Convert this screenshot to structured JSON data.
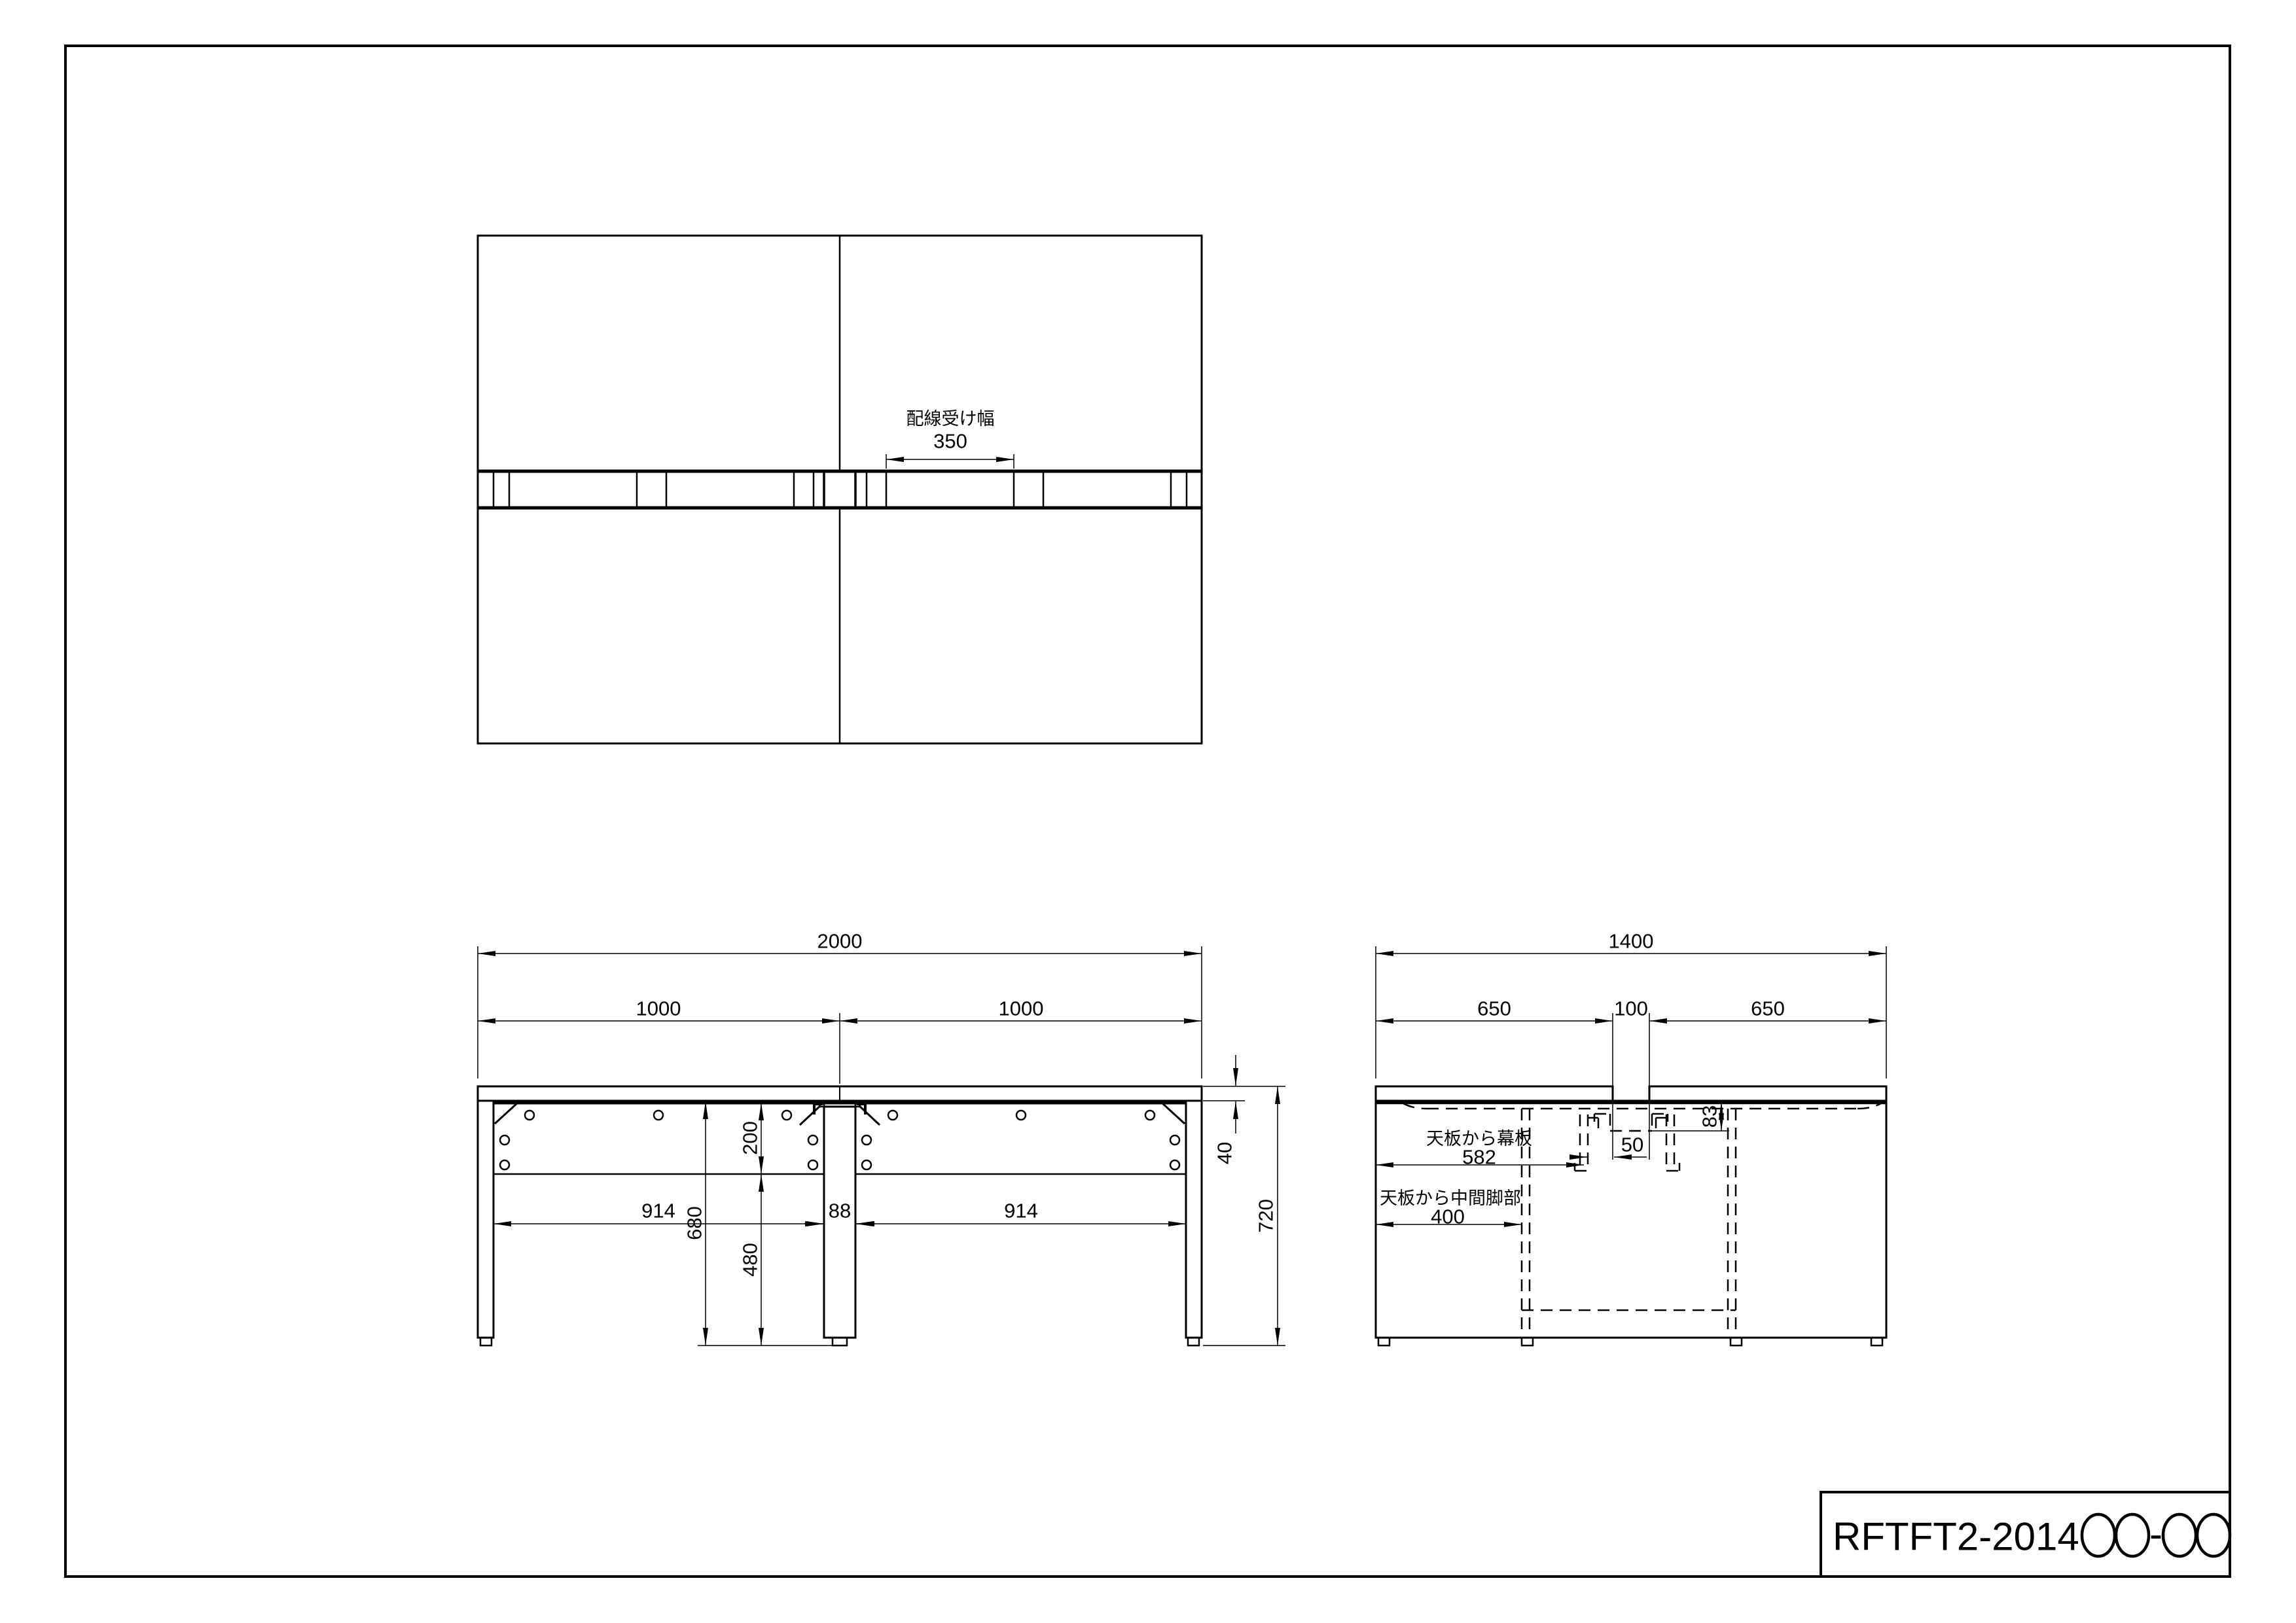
{
  "colors": {
    "ink": "#000000",
    "paper": "#ffffff"
  },
  "title_block": {
    "code_prefix": "RFTFT2-2014",
    "code_separator": "-"
  },
  "top_view": {
    "cable_width_label": "配線受け幅",
    "cable_width_value": "350"
  },
  "front_view": {
    "overall_width": "2000",
    "left_half_width": "1000",
    "right_half_width": "1000",
    "left_leg_span": "914",
    "center_leg_width": "88",
    "right_leg_span": "914",
    "panel_height": "200",
    "panel_bottom_to_floor": "480",
    "under_top_to_floor": "680",
    "top_thickness": "40",
    "total_height": "720"
  },
  "side_view": {
    "overall_depth": "1400",
    "left_top_depth": "650",
    "center_gap": "100",
    "right_top_depth": "650",
    "top_to_panel_label": "天板から幕板",
    "top_to_panel_value": "582",
    "top_to_midleg_label": "天板から中間脚部",
    "top_to_midleg_value": "400",
    "panel_clearance": "50",
    "tray_depth": "83"
  }
}
